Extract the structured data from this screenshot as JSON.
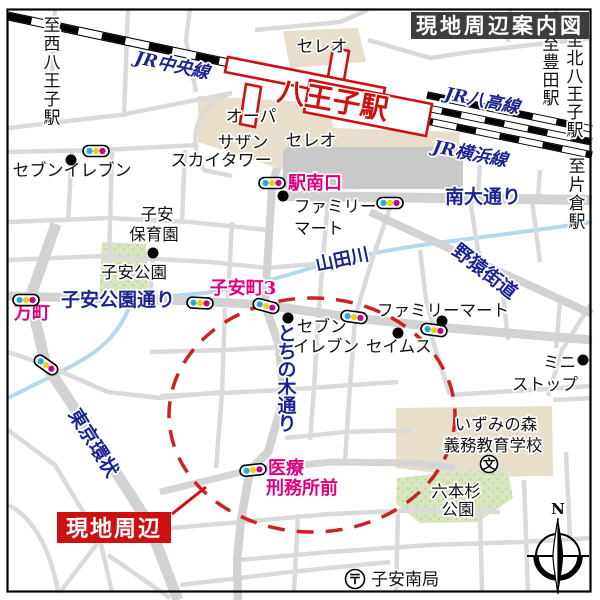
{
  "title": "現地周辺案内図",
  "callout": {
    "label": "現地周辺"
  },
  "station": {
    "name": "八王子駅"
  },
  "rails": {
    "chuo": "JR中央線",
    "hachiko": "JR八高線",
    "yokohama": "JR横浜線"
  },
  "directions": {
    "nishi_hachioji": "至西八王子駅",
    "toyoda": "至豊田駅",
    "kita_hachioji": "至北八王子駅",
    "katakura": "至片倉駅"
  },
  "roads": {
    "minami_odori": "南大通り",
    "koyasu_koen_dori": "子安公園通り",
    "tochinoki_dori": "とちの木通り",
    "tokyo_kanjo": "東京環状",
    "yaen_kaido": "野猿街道"
  },
  "river": {
    "name": "山田川"
  },
  "crossings": {
    "eki_minamiguchi": "駅南口",
    "koyasucho3": "子安町3",
    "mancho": "万町",
    "iryo_line1": "医療",
    "iryo_line2": "刑務所前"
  },
  "places": {
    "celeo_north": "セレオ",
    "celeo_south": "セレオ",
    "opa": "オーパ",
    "southern": "サザン",
    "sky_tower": "スカイタワー",
    "seven_eleven_north": "セブンイレブン",
    "family_mart_north_1": "ファミリー",
    "family_mart_north_2": "マート",
    "koyasu_hoikuen_1": "子安",
    "koyasu_hoikuen_2": "保育園",
    "koyasu_park": "子安公園",
    "seven_1": "セブン",
    "seven_2": "イレブン",
    "seims": "セイムス",
    "family_mart_south": "ファミリーマート",
    "ministop_1": "ミニ",
    "ministop_2": "ストップ",
    "izuminomori_1": "いずみの森",
    "izuminomori_2": "義務教育学校",
    "ropponsugi_1": "六本杉",
    "ropponsugi_2": "公園",
    "koyasu_minami_kyoku": "子安南局"
  },
  "symbols": {
    "school": "文",
    "post_office": "〒",
    "compass_north": "N"
  },
  "colors": {
    "road_label_navy": "#1c2490",
    "crossing_label_pink": "#e0007f",
    "station_red": "#cc1111",
    "circle_red": "#cc2222",
    "signal_blue": "#29a8dc",
    "signal_yellow": "#f2cf0e",
    "signal_magenta": "#c4008c",
    "park_green": "#d8e6c0",
    "building_beige": "#e7dfcb",
    "road_gray": "#d5d5d5",
    "river_blue": "#b5d9ea",
    "title_bg": "#3d3d3d"
  }
}
